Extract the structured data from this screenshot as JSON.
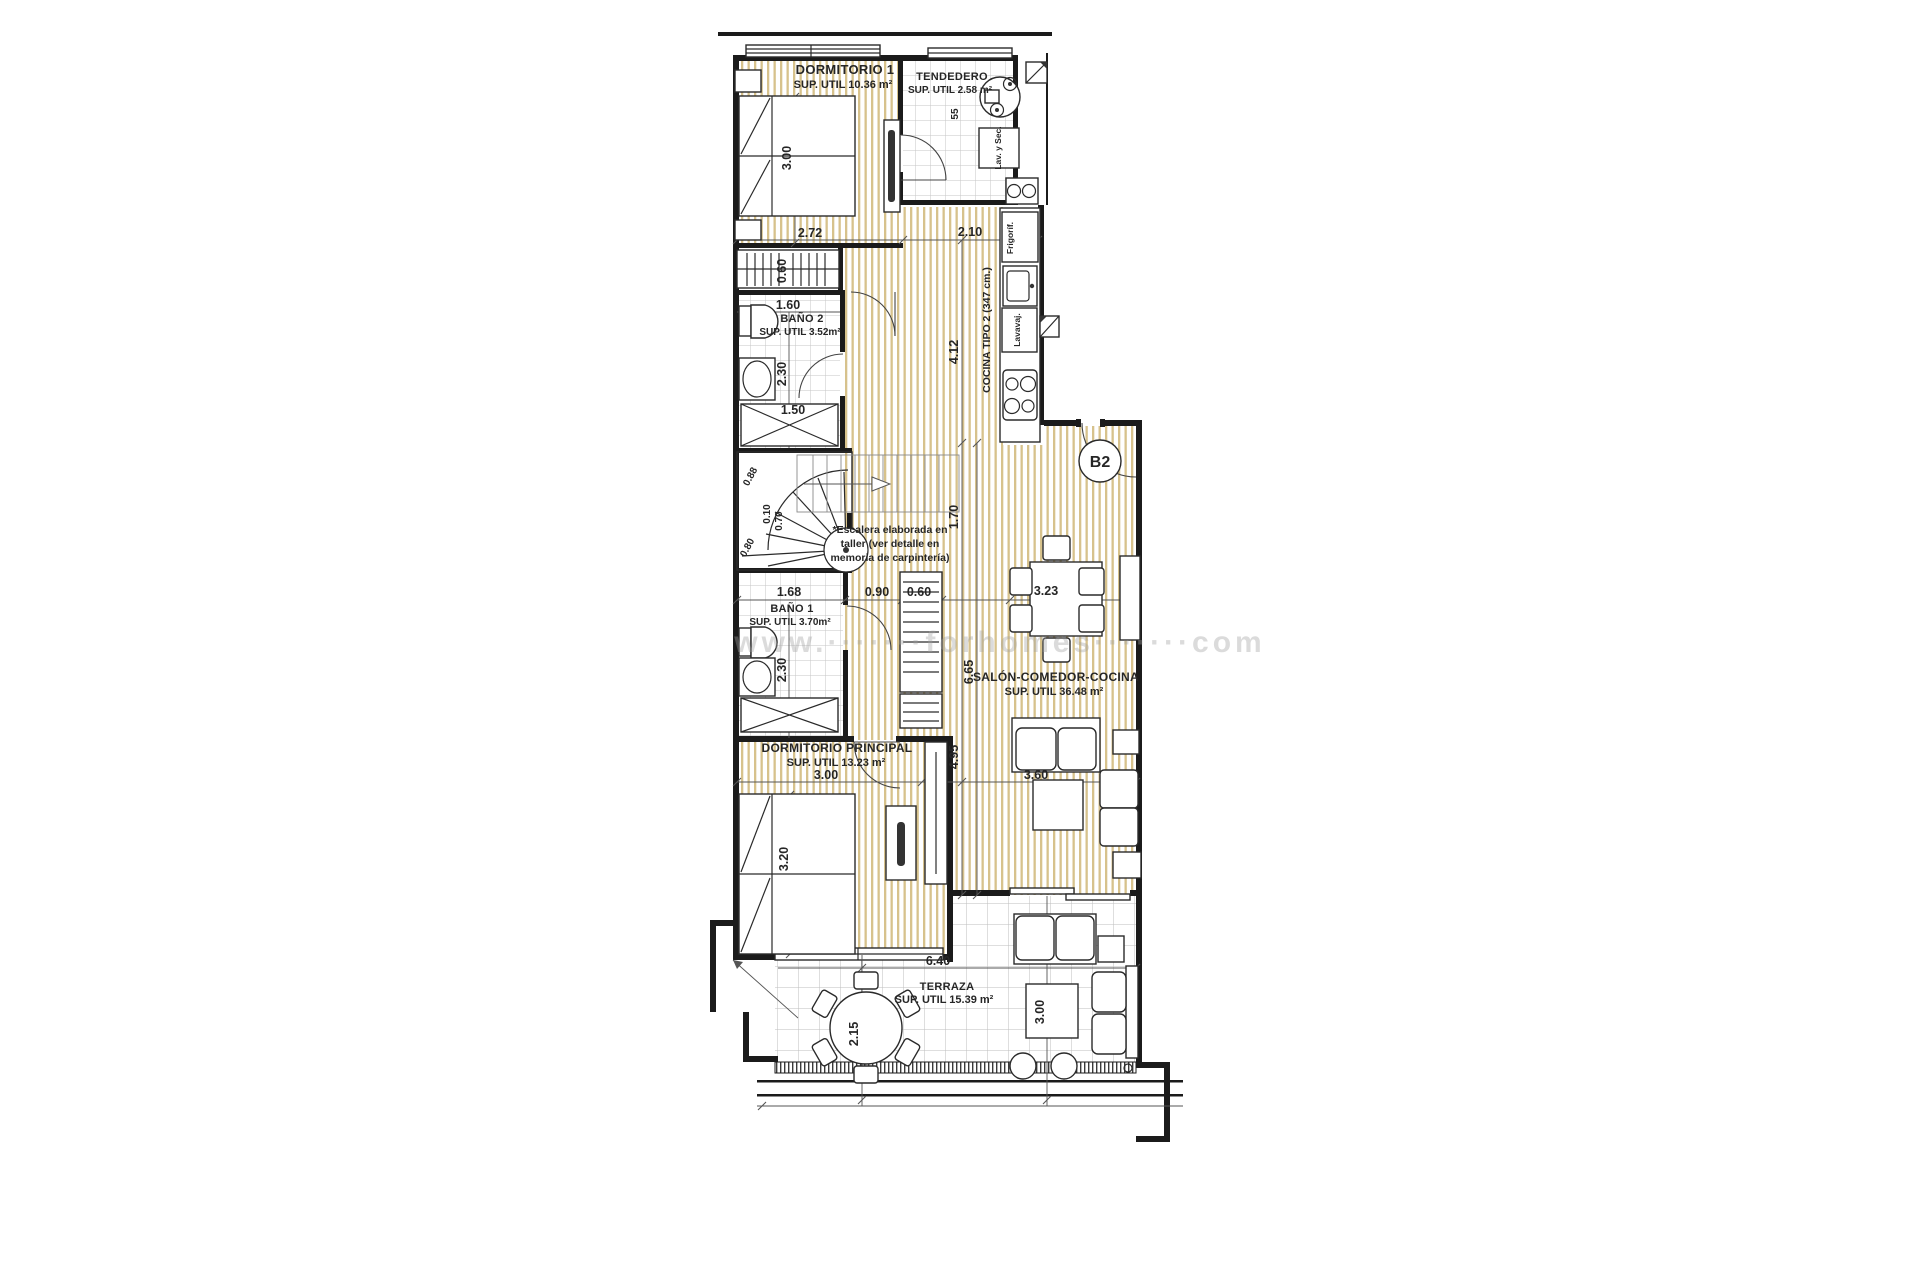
{
  "plan": {
    "unit_label": "B2",
    "watermark": "www.·······forhomes·······com",
    "rooms": {
      "dormitorio1": {
        "name": "DORMITORIO 1",
        "area": "SUP. UTIL 10.36 m²"
      },
      "tendedero": {
        "name": "TENDEDERO",
        "area": "SUP. UTIL 2.58 m²"
      },
      "bano2": {
        "name": "BAÑO 2",
        "area": "SUP. UTIL 3.52m²"
      },
      "bano1": {
        "name": "BAÑO 1",
        "area": "SUP. UTIL 3.70m²"
      },
      "dormitorio_principal": {
        "name": "DORMITORIO PRINCIPAL",
        "area": "SUP. UTIL 13.23 m²"
      },
      "salon_comedor_cocina": {
        "name": "SALÓN-COMEDOR-COCINA",
        "area": "SUP. UTIL 36.48 m²"
      },
      "terraza": {
        "name": "TERRAZA",
        "area": "SUP. UTIL 15.39 m²"
      }
    },
    "kitchen": {
      "label": "COCINA TIPO 2 (347 cm.)",
      "fridge": "Frigoríf.",
      "dishwasher": "Lavavaj.",
      "washer_dryer": "Lav. y Sec."
    },
    "stair_note": {
      "line1": "*Escalera elaborada en",
      "line2": "taller (ver detalle en",
      "line3": "memoria de carpintería)"
    },
    "dims": {
      "dorm1_width": "2.72",
      "hall_top": "2.10",
      "dorm1_bed": "3.00",
      "wardrobe_depth": "0.60",
      "bano2_width": "1.60",
      "bano2_len": "2.30",
      "shower2_width": "1.50",
      "kitchen_len": "4.12",
      "hall_len": "1.70",
      "salon_len": "6.65",
      "dormp_zone_len": "4.95",
      "stair_a": "0.88",
      "stair_b": "0.10",
      "stair_c": "0.70",
      "stair_d": "0.80",
      "bano1_width": "1.68",
      "pass_width": "0.90",
      "closet_depth": "0.60",
      "salon_width": "3.23",
      "bano1_len": "2.30",
      "dormp_width": "3.00",
      "dormp_bed": "3.20",
      "sofa_zone": "3.60",
      "terraza_width": "6.40",
      "terraza_len": "2.15",
      "terraza_sofa_zone": "3.00",
      "tendedero_w": "55"
    }
  }
}
